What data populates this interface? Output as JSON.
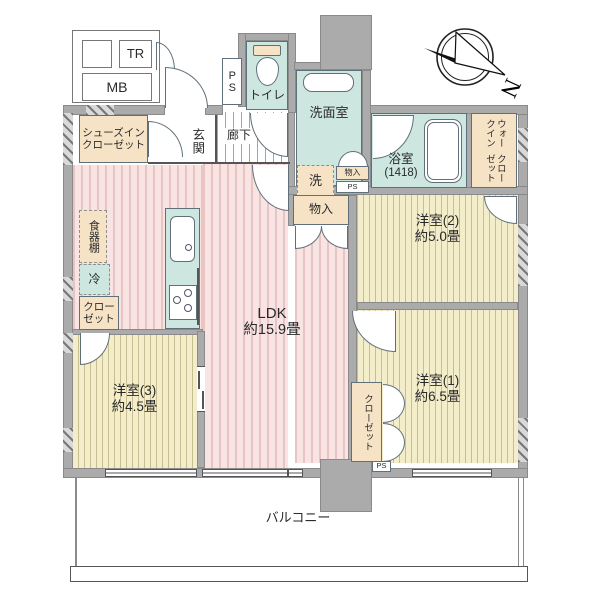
{
  "plan_title": "間取り図",
  "mailbox_area": {
    "tr": "TR",
    "mb": "MB"
  },
  "entrance": {
    "genkan": "玄関",
    "corridor": "廊下",
    "shoes_closet_line1": "シューズイン",
    "shoes_closet_line2": "クローゼット"
  },
  "sanitary": {
    "toilet": "トイレ",
    "washroom": "洗面室",
    "washer": "洗",
    "bath_name": "浴室",
    "bath_size": "(1418)",
    "ps_shaft": "PS",
    "ps_small": "PS",
    "monoire_small": "物入",
    "monoire": "物入"
  },
  "storage": {
    "wic_line1": "ウォークイン",
    "wic_line2": "クローゼット",
    "closet_bedroom1": "クローゼット",
    "closet_bedroom3_line1": "クロー",
    "closet_bedroom3_line2": "ゼット",
    "dish_shelf": "食器棚",
    "fridge": "冷"
  },
  "rooms": {
    "ldk_name": "LDK",
    "ldk_size": "約15.9畳",
    "bedroom1_name": "洋室(1)",
    "bedroom1_size": "約6.5畳",
    "bedroom2_name": "洋室(2)",
    "bedroom2_size": "約5.0畳",
    "bedroom3_name": "洋室(3)",
    "bedroom3_size": "約4.5畳"
  },
  "outdoor": {
    "balcony": "バルコニー",
    "ps_bottom": "PS"
  },
  "compass": {
    "north": "N"
  },
  "colors": {
    "wall": "#ababab",
    "mint": "#cde7e0",
    "peach": "#f6e3c6",
    "pink_bg": "#f9e4e4",
    "pink_stripe": "#eac3c3",
    "beige_bg": "#f4edca",
    "beige_stripe": "#c9bd92"
  }
}
